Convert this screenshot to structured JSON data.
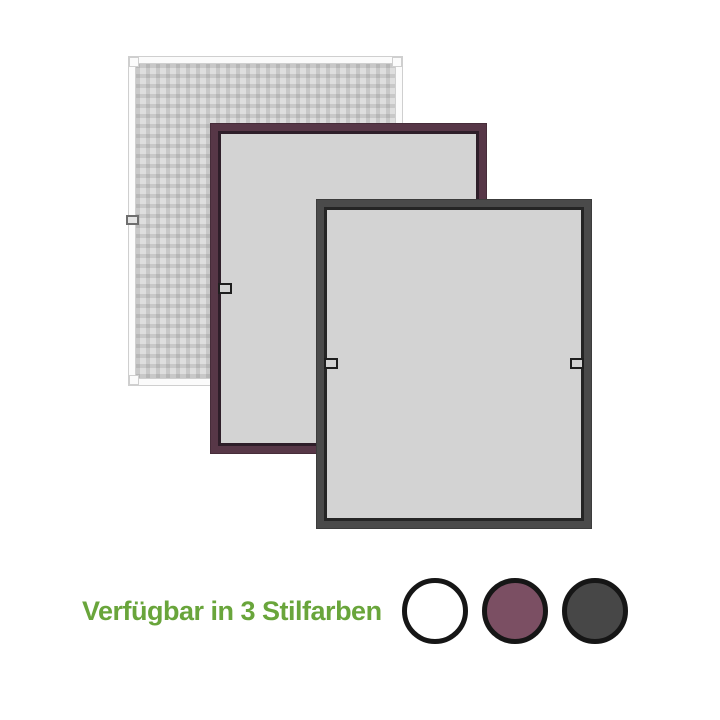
{
  "page": {
    "background": "#ffffff"
  },
  "caption": {
    "text": "Verfügbar in 3 Stilfarben",
    "color": "#69a53b"
  },
  "product": {
    "windows": [
      {
        "id": "white",
        "frame_color": "#fbfbfb",
        "frame_line_color": "#cfcfcf",
        "pane_color": "#dedede",
        "pane_style": "mesh",
        "handles": [
          "left"
        ]
      },
      {
        "id": "bordeaux",
        "frame_color": "#573747",
        "frame_line_color": "#2e1e29",
        "pane_color": "#d3d3d3",
        "pane_style": "plain",
        "handles": [
          "left"
        ]
      },
      {
        "id": "anthracite",
        "frame_color": "#4a4a4a",
        "frame_line_color": "#252525",
        "pane_color": "#d3d3d3",
        "pane_style": "plain",
        "handles": [
          "left",
          "right"
        ]
      }
    ]
  },
  "swatches": [
    {
      "id": "white",
      "fill": "#ffffff",
      "border": "#161616"
    },
    {
      "id": "bordeaux",
      "fill": "#7b4f63",
      "border": "#161616"
    },
    {
      "id": "anthracite",
      "fill": "#474747",
      "border": "#161616"
    }
  ]
}
